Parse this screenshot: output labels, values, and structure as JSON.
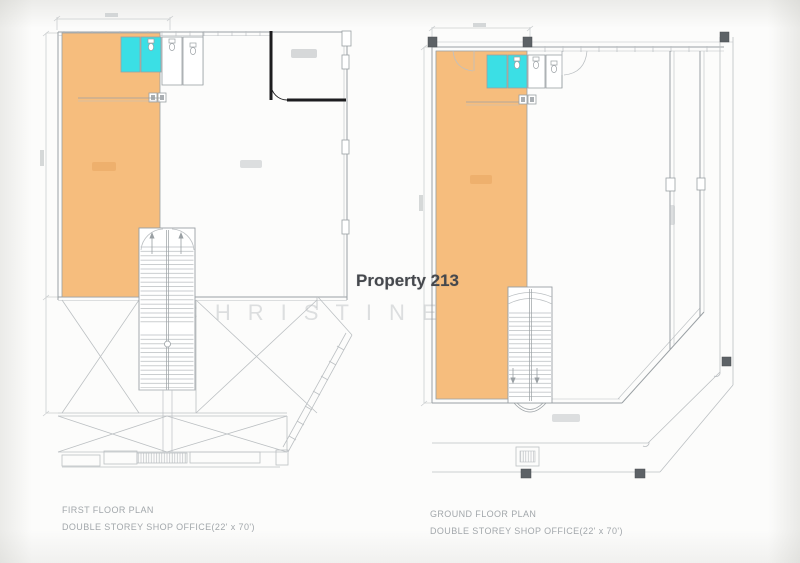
{
  "overlay": {
    "property_label": "Property 213",
    "watermark": "CHRISTINE LIU"
  },
  "plans": [
    {
      "name": "FIRST FLOOR PLAN",
      "subtitle": "DOUBLE STOREY SHOP OFFICE(22' x 70')"
    },
    {
      "name": "GROUND FLOOR PLAN",
      "subtitle": "DOUBLE STOREY SHOP OFFICE(22' x 70')"
    }
  ],
  "colors": {
    "bg": "#fcfcfb",
    "line": "#bcc0c3",
    "line_dark": "#9aa0a4",
    "dim": "#cbced0",
    "highlight": "#f6bd7d",
    "toilet": "#3bdfe5",
    "wall": "#1d1d1f",
    "column": "#5d6266",
    "caption": "#a2a7ab",
    "title": "#45484d",
    "watermark": "#dcdedf"
  }
}
